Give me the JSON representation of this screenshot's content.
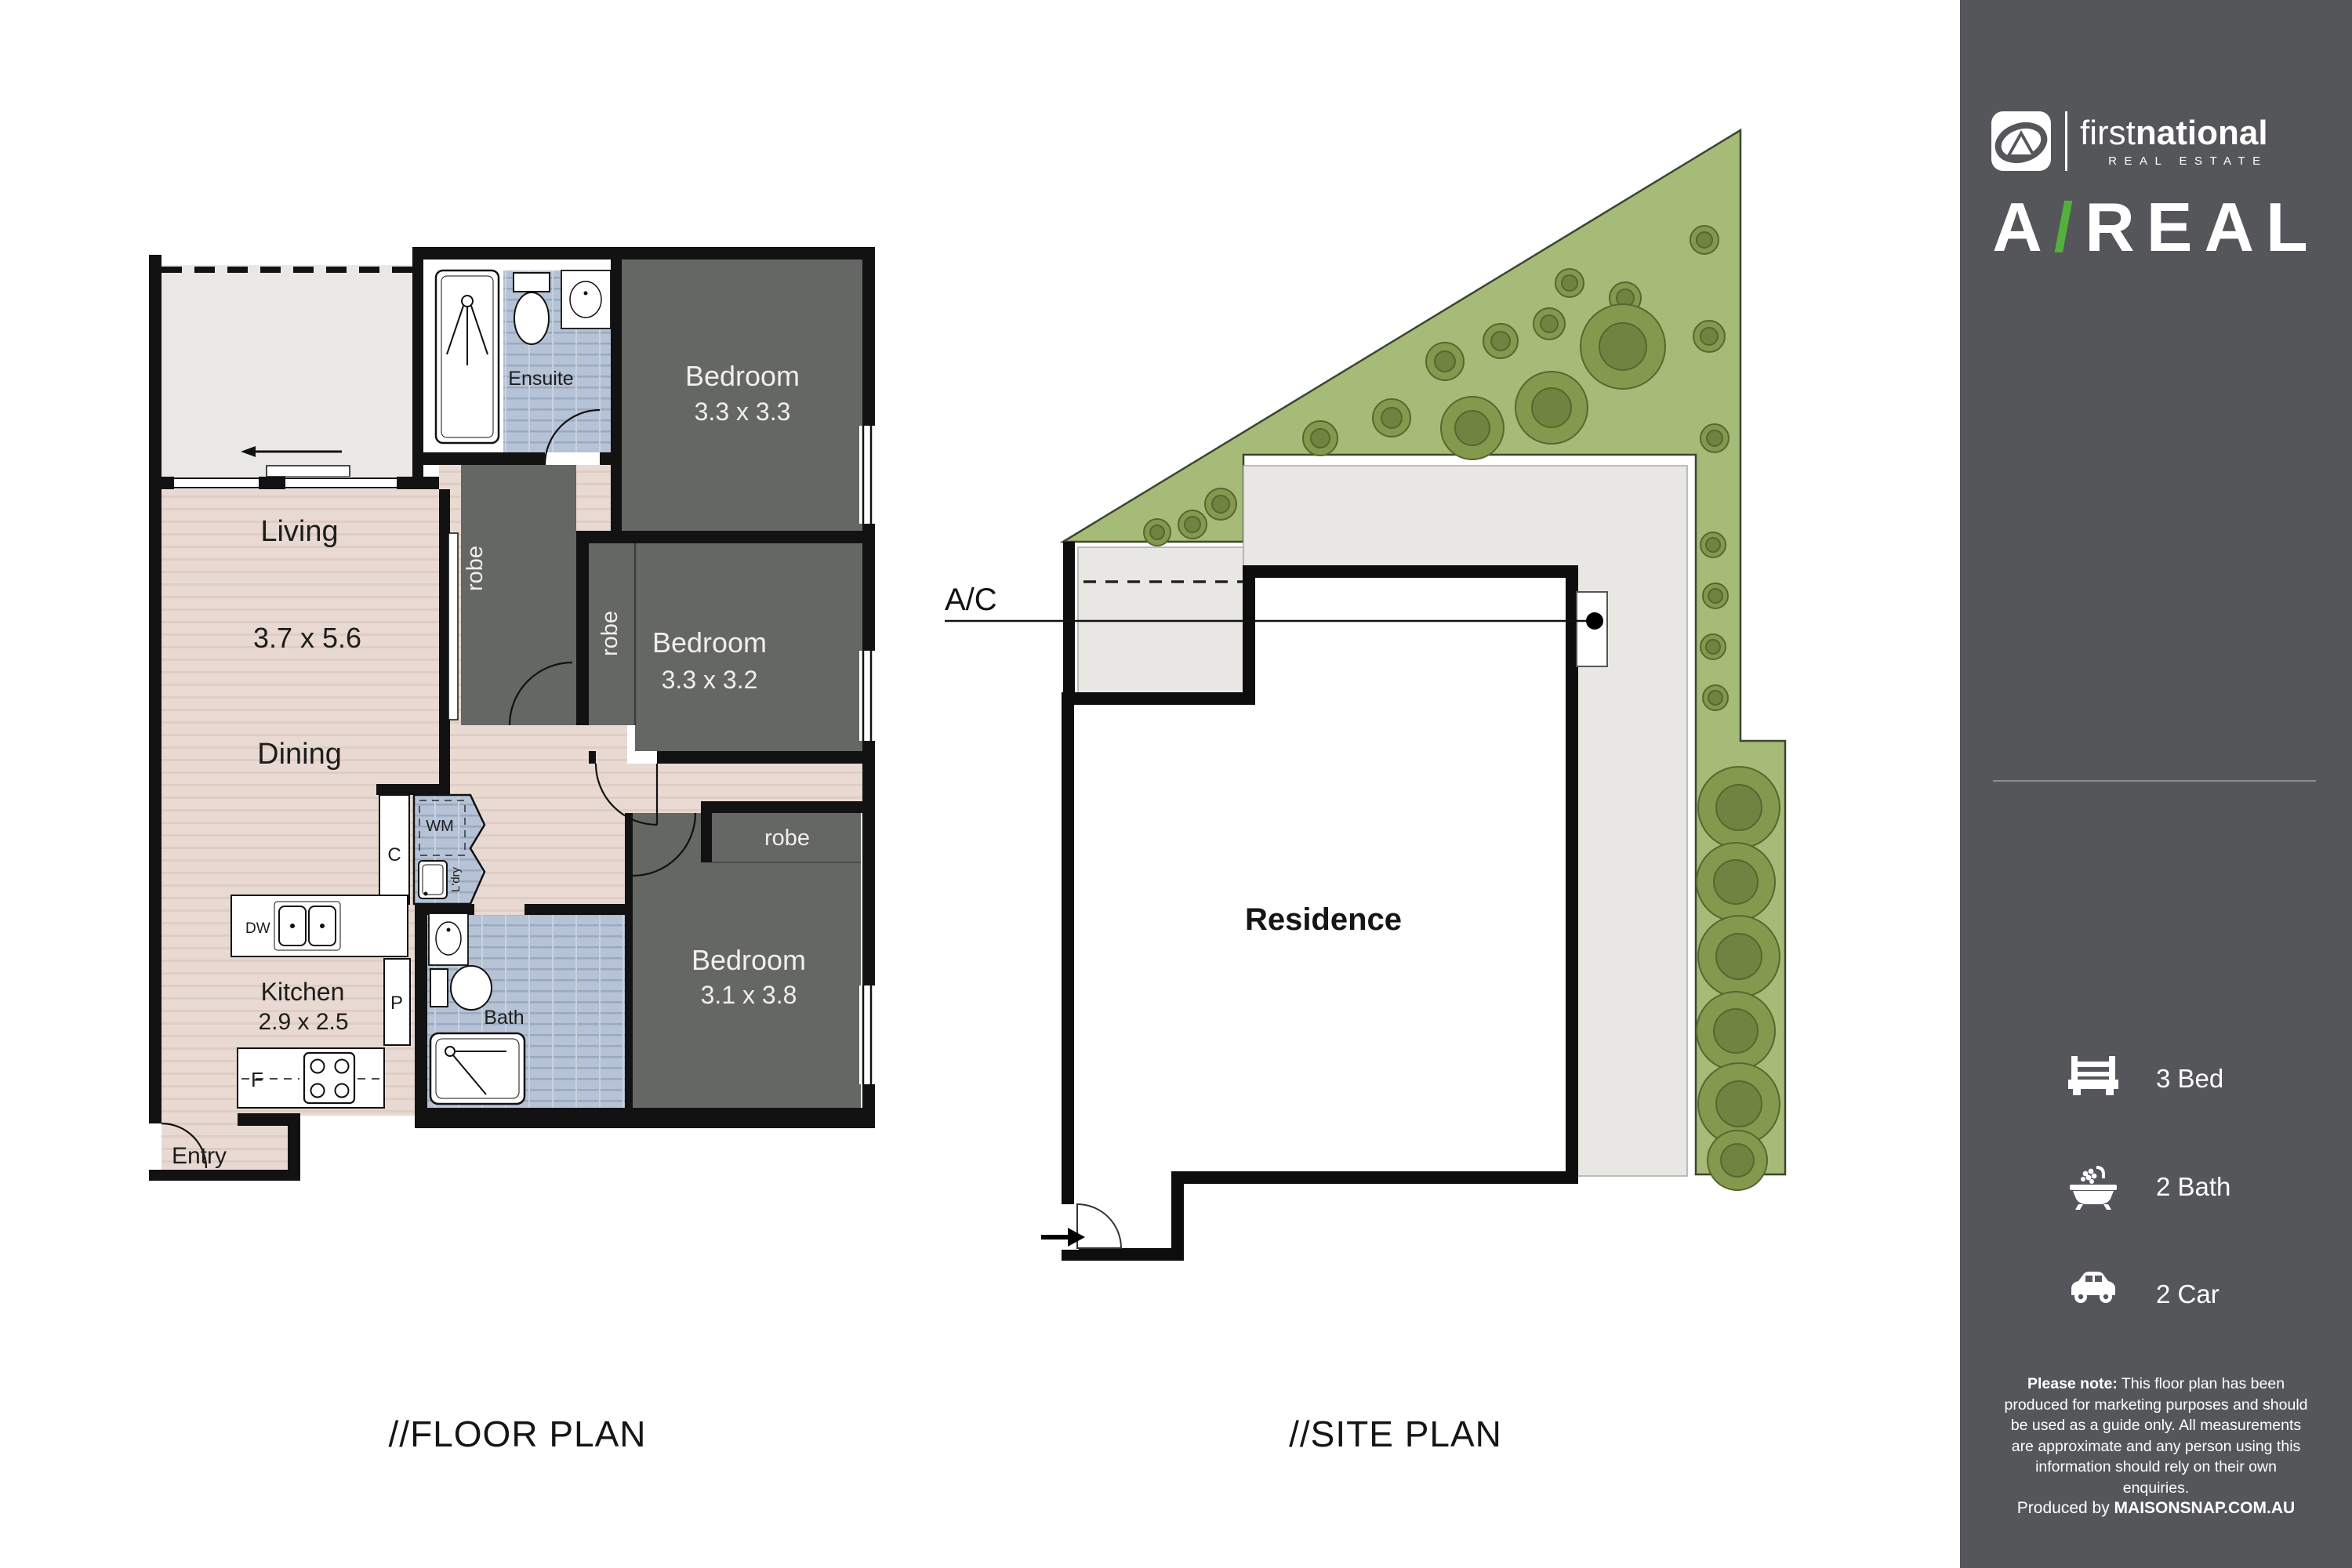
{
  "fp": {
    "title": "//FLOOR PLAN",
    "living": "Living",
    "living_dims": "3.7 x 5.6",
    "dining": "Dining",
    "kitchen": "Kitchen",
    "kitchen_dims": "2.9 x 2.5",
    "entry": "Entry",
    "ensuite": "Ensuite",
    "bath": "Bath",
    "bed1": "Bedroom",
    "bed1_dims": "3.3 x 3.3",
    "bed2": "Bedroom",
    "bed2_dims": "3.3 x 3.2",
    "bed3": "Bedroom",
    "bed3_dims": "3.1 x 3.8",
    "robe": "robe",
    "wm": "WM",
    "ldry": "L'dry",
    "c": "C",
    "p": "P",
    "f": "F",
    "dw": "DW"
  },
  "site": {
    "title": "//SITE PLAN",
    "residence": "Residence",
    "ac": "A/C"
  },
  "sidebar": {
    "brand": {
      "name_first": "first",
      "name_rest": "national",
      "tagline": "REAL ESTATE",
      "agency_a": "A",
      "agency_slash": "/",
      "agency_rest": "REAL"
    },
    "stats": [
      {
        "icon": "bed-icon",
        "label": "3 Bed"
      },
      {
        "icon": "bath-icon",
        "label": "2 Bath"
      },
      {
        "icon": "car-icon",
        "label": "2 Car"
      }
    ],
    "disclaimer_bold": "Please note:",
    "disclaimer_rest": " This floor plan has been produced for marketing purposes and should be used as a guide only. All measurements are approximate and any person using this information should rely on their own enquiries.",
    "produced_by": "Produced by ",
    "produced_by_brand": "MAISONSNAP.COM.AU"
  },
  "colors": {
    "sidebar_bg": "#54565A",
    "accent_green": "#53B13B",
    "site_green": "#A6BB77",
    "floor_beige": "#E8DAD2",
    "room_gray": "#646764",
    "tile_blue": "#B6C3D6",
    "wall_black": "#121212"
  }
}
